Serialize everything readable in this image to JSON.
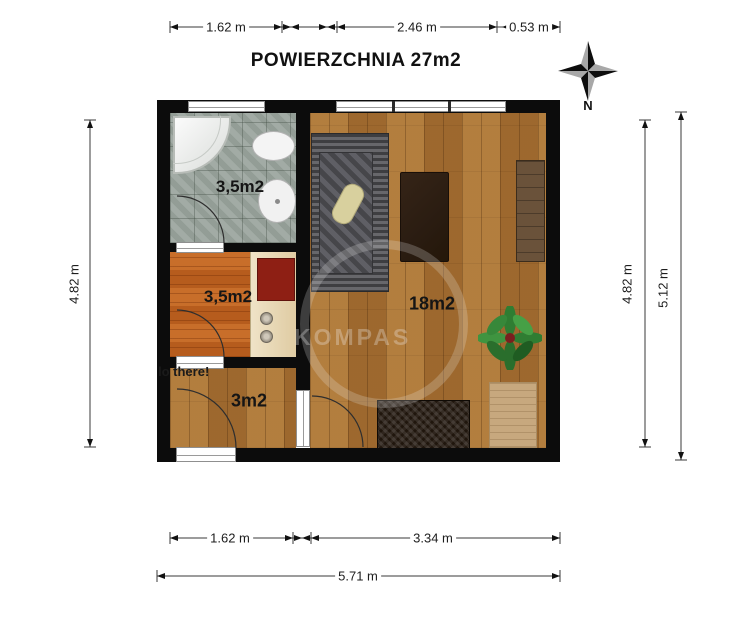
{
  "title": "POWIERZCHNIA 27m2",
  "compass": {
    "label": "N"
  },
  "watermark": "KOMPAS",
  "annotation": "lo there!",
  "dimensions": {
    "top": [
      "1.62 m",
      "2.46 m",
      "0.53 m"
    ],
    "left": "4.82 m",
    "right_inner": "4.82 m",
    "right_outer": "5.12 m",
    "bottom": [
      "1.62 m",
      "3.34 m"
    ],
    "bottom_total": "5.71 m"
  },
  "rooms": [
    {
      "name": "bathroom",
      "area": "3,5m2"
    },
    {
      "name": "kitchen",
      "area": "3,5m2"
    },
    {
      "name": "hall",
      "area": "3m2"
    },
    {
      "name": "living-room",
      "area": "18m2"
    }
  ],
  "colors": {
    "wall": "#0c0c0c",
    "wood_floor": "#aa7334",
    "kitchen_floor": "#c06320",
    "bathroom_floor": "#9ba59e",
    "counter": "#ead9b8",
    "cooktop_red": "#8e1f14",
    "sofa_gray": "#4a4a4e"
  }
}
